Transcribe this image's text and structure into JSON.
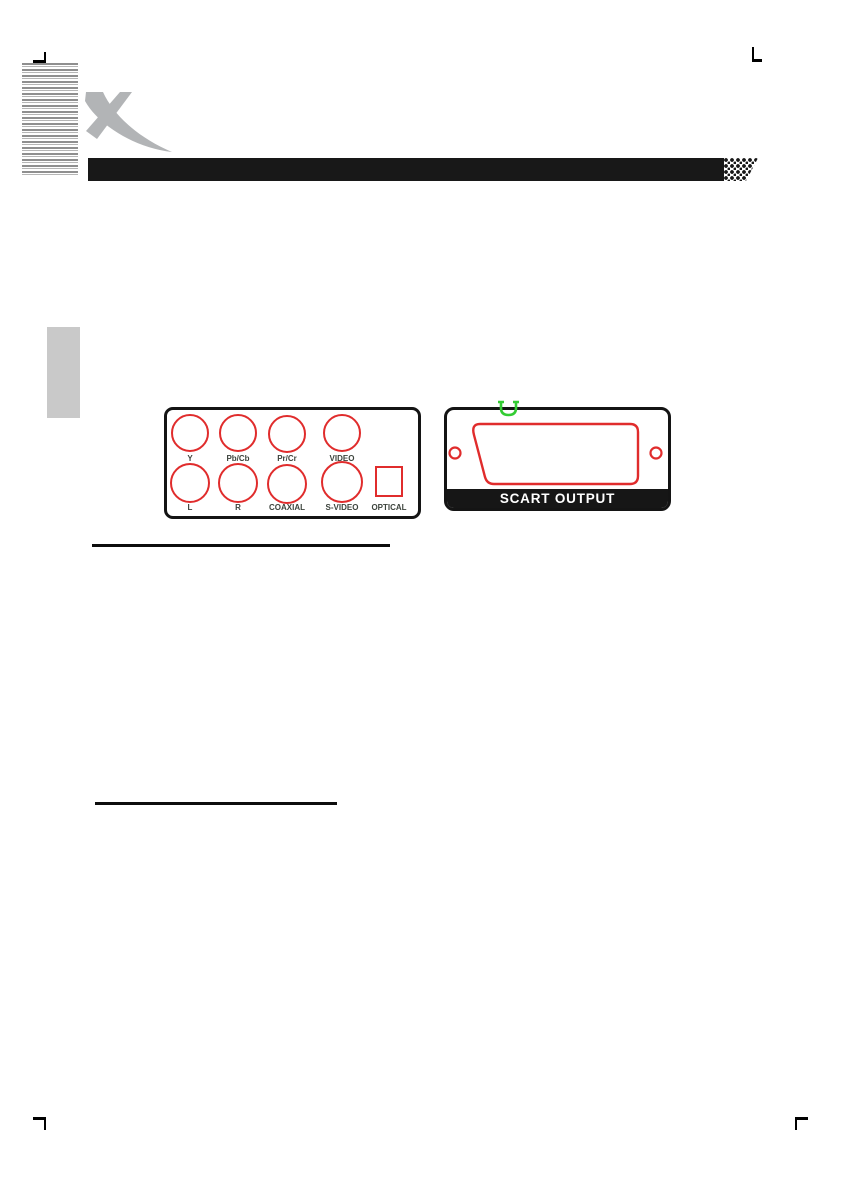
{
  "av_panel": {
    "jacks_top": [
      "Y",
      "Pb/Cb",
      "Pr/Cr",
      "VIDEO"
    ],
    "jacks_bottom": [
      "L",
      "R",
      "COAXIAL",
      "S-VIDEO"
    ],
    "optical_label": "OPTICAL"
  },
  "scart_panel": {
    "label": "SCART OUTPUT"
  },
  "colors": {
    "jack_red": "#e02c2c",
    "marker_green": "#33cc33",
    "header_black": "#181818",
    "logo_gray": "#b2b4b6",
    "tab_gray": "#c9c9c9"
  }
}
